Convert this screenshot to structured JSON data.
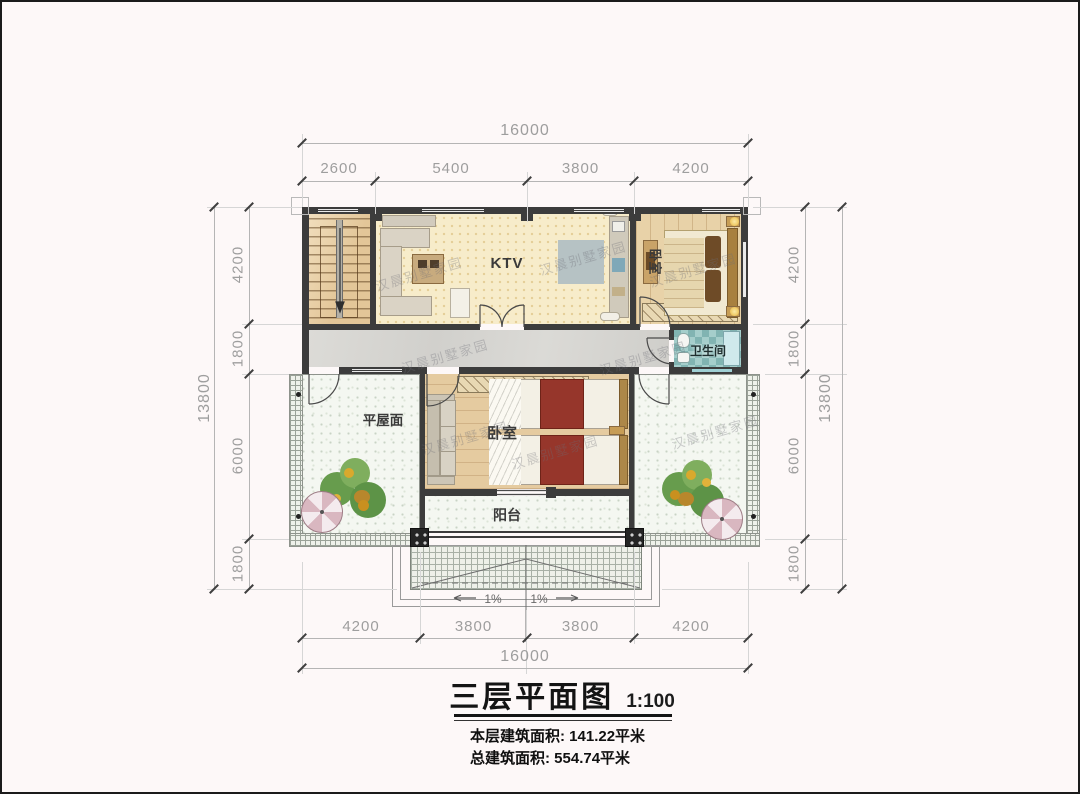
{
  "title_block": {
    "title": "三层平面图",
    "scale": "1:100",
    "floor_area": "本层建筑面积: 141.22平米",
    "total_area": "总建筑面积: 554.74平米"
  },
  "rooms": {
    "ktv": "KTV",
    "bedroom_top": "卧室",
    "bathroom": "卫生间",
    "flat_roof": "平屋面",
    "bedroom_main": "卧室",
    "balcony": "阳台"
  },
  "dimensions": {
    "top": {
      "overall": "16000",
      "segments": [
        "2600",
        "5400",
        "3800",
        "4200"
      ]
    },
    "bottom": {
      "overall": "16000",
      "segments": [
        "4200",
        "3800",
        "3800",
        "4200"
      ]
    },
    "left": {
      "overall": "13800",
      "segments": [
        "4200",
        "1800",
        "6000",
        "1800"
      ]
    },
    "right": {
      "overall": "13800",
      "segments": [
        "4200",
        "1800",
        "6000",
        "1800"
      ]
    }
  },
  "annotations": {
    "slope_left": "1%",
    "slope_right": "1%"
  },
  "watermark": {
    "text": "汉晨别墅家园"
  },
  "colors": {
    "wall": "#3c3c3c",
    "corridor": "#d6d5d1",
    "wood_floor": "#e7cfa4",
    "ktv_floor": "#f7ecca",
    "bathroom_tile": "#8cc0bd",
    "terrace": "#f4f7f1",
    "bed_blanket_red": "#96362b",
    "umbrella_pink": "#d9b7c0",
    "dim_text": "#9e9e9e"
  }
}
